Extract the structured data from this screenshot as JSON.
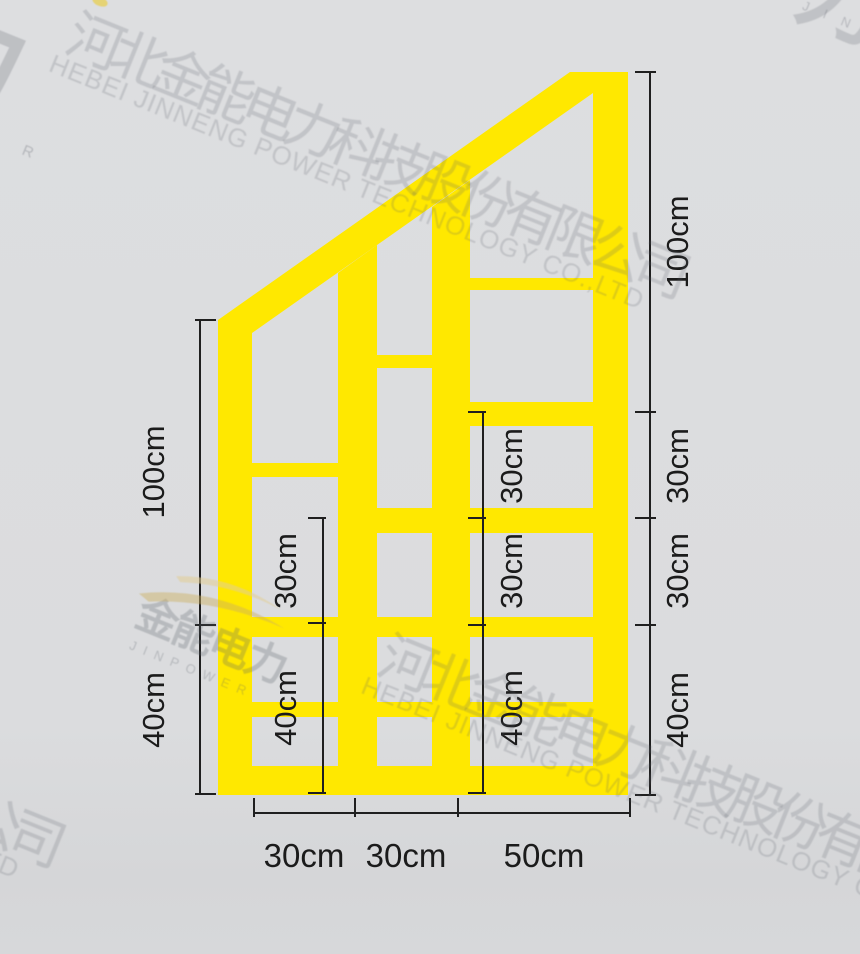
{
  "background": {
    "color": "#DBDCDE"
  },
  "frame": {
    "color": "#FFE800"
  },
  "dimensions": {
    "line_color": "#1F1F1F",
    "left": {
      "labels": [
        "100cm",
        "40cm"
      ]
    },
    "inner_left": {
      "labels": [
        "30cm",
        "40cm"
      ]
    },
    "inner_right": {
      "labels": [
        "30cm",
        "30cm",
        "40cm"
      ]
    },
    "right": {
      "labels": [
        "100cm",
        "30cm",
        "30cm",
        "40cm"
      ]
    },
    "bottom": {
      "labels": [
        "30cm",
        "30cm",
        "50cm"
      ]
    }
  },
  "watermark": {
    "company_cn": "河北金能电力科技股份有限公司",
    "company_en": "HEBEI JINNENG POWER TECHNOLOGY CO.,LTD",
    "logo_cn": "金能电力",
    "logo_en": "JINPOWER",
    "corner_jin": "J I N",
    "corner_char": "力",
    "registered_mark": "R",
    "bottom_fragment_cn": "公司",
    "bottom_fragment_en": "TD"
  }
}
